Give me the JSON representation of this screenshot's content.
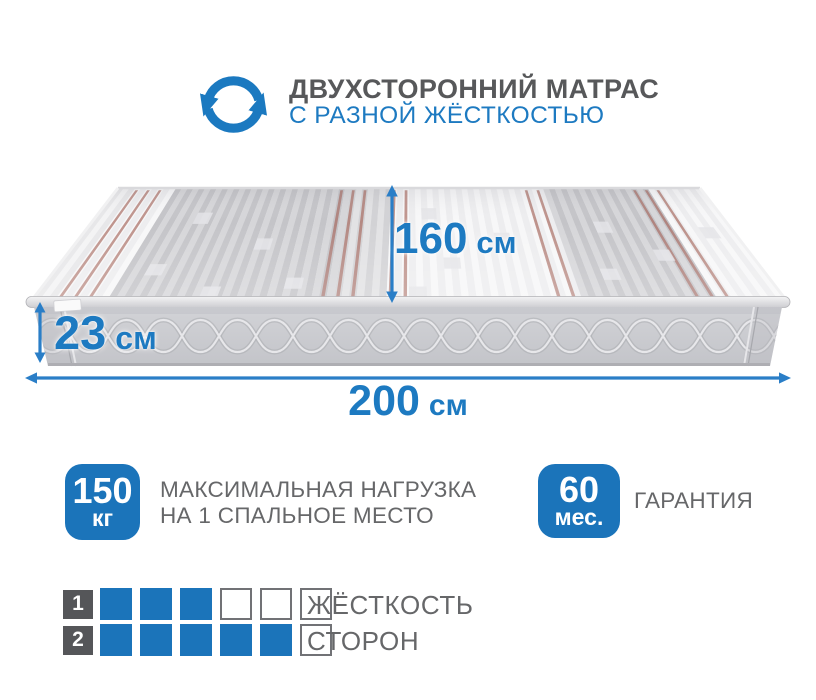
{
  "colors": {
    "accent": "#1b74ba",
    "accent_text": "#1d7ac1",
    "title_gray": "#57585a",
    "desc_gray": "#666769"
  },
  "header": {
    "icon": "two-sided-rotate-icon",
    "title": "ДВУХСТОРОННИЙ МАТРАС",
    "subtitle": "С РАЗНОЙ ЖЁСТКОСТЬЮ"
  },
  "dimensions": {
    "depth": {
      "value": "160",
      "unit": "см"
    },
    "height": {
      "value": "23",
      "unit": "см"
    },
    "length": {
      "value": "200",
      "unit": "см"
    }
  },
  "features": {
    "max_load": {
      "value": "150",
      "unit": "кг",
      "description_line1": "МАКСИМАЛЬНАЯ НАГРУЗКА",
      "description_line2": "НА 1 СПАЛЬНОЕ МЕСТО"
    },
    "warranty": {
      "value": "60",
      "unit": "мес.",
      "description": "ГАРАНТИЯ"
    }
  },
  "firmness": {
    "scale_max": 6,
    "label_line1": "ЖЁСТКОСТЬ",
    "label_line2": "СТОРОН",
    "sides": [
      {
        "number": "1",
        "level": 3
      },
      {
        "number": "2",
        "level": 5
      }
    ]
  }
}
